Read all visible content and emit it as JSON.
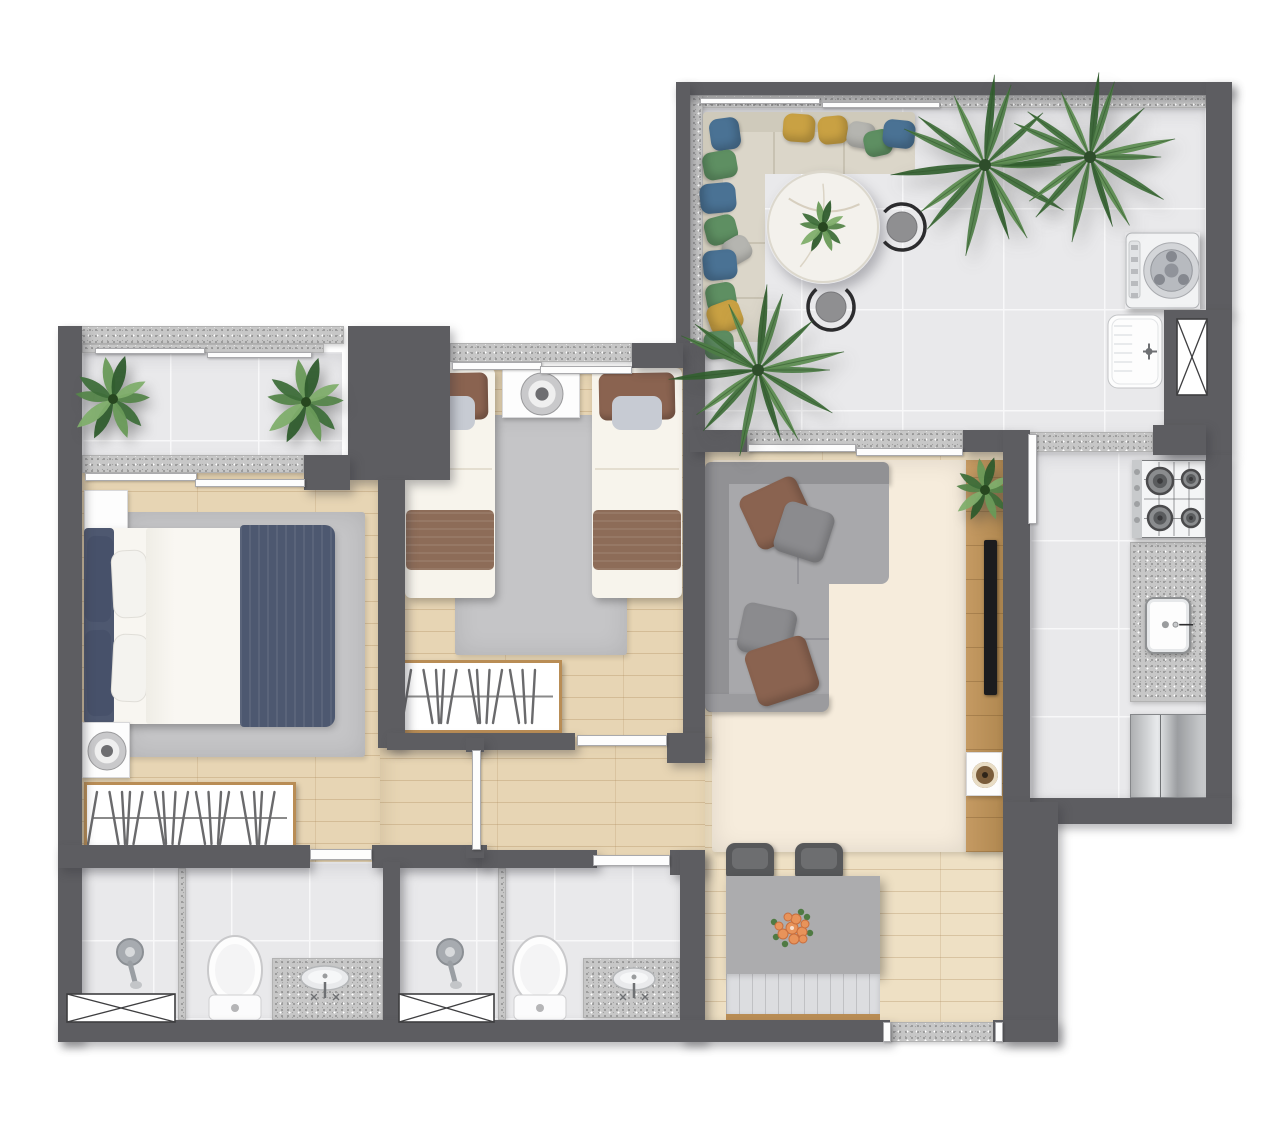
{
  "meta": {
    "description": "top-down rendered apartment floor plan, no visible text",
    "canvas": {
      "w": 1280,
      "h": 1130
    }
  },
  "palette": {
    "wall": "#5d5d61",
    "granite": "#c7c7c7",
    "tile": "#e9e9eb",
    "wood": "#e7d5b4",
    "wood_light": "#eee0c4",
    "rug_gray": "#c5c5c7",
    "rug_cream": "#f6ecdc",
    "sofa_gray": "#a6a6a9",
    "sofa_back": "#919194",
    "terrace_sofa": "#d9d4c6",
    "navy": "#4d5870",
    "brown": "#8a6350",
    "yellow": "#c9a143",
    "blue": "#4a7294",
    "green": "#5e8f62",
    "lt_gray": "#b5b5b0",
    "mid_gray": "#8b8b8e",
    "chair_dark": "#57585a",
    "wood_trim": "#b98d55",
    "marble": "#f3f1ec",
    "steel": "#c0c2c4",
    "plant_green": "#4e7d46",
    "flower_orange": "#e8935a"
  },
  "items": [
    {
      "n": "terrace-floor",
      "k": "tile",
      "r": [
        700,
        107,
        506,
        325
      ],
      "o": {
        "g": 101
      }
    },
    {
      "n": "balcony-floor",
      "k": "tile",
      "r": [
        82,
        352,
        260,
        105
      ],
      "o": {
        "g": 88
      }
    },
    {
      "n": "kitchen-floor",
      "k": "tile",
      "r": [
        1030,
        452,
        176,
        346
      ],
      "o": {
        "g": 88
      }
    },
    {
      "n": "bathroom-1-floor",
      "k": "tile",
      "r": [
        75,
        862,
        310,
        160
      ],
      "o": {
        "g": 78
      }
    },
    {
      "n": "bathroom-2-floor",
      "k": "tile",
      "r": [
        398,
        862,
        284,
        160
      ],
      "o": {
        "g": 78
      }
    },
    {
      "n": "master-bedroom-floor",
      "k": "wood",
      "r": [
        80,
        470,
        300,
        392
      ]
    },
    {
      "n": "twin-bedroom-floor",
      "k": "wood",
      "r": [
        388,
        368,
        295,
        380
      ]
    },
    {
      "n": "hallway-floor",
      "k": "wood",
      "r": [
        380,
        737,
        325,
        125
      ]
    },
    {
      "n": "living-dining-floor",
      "k": "wood",
      "r": [
        705,
        452,
        298,
        570
      ],
      "o": {
        "light": true
      }
    },
    {
      "n": "terrace-top-ledge",
      "k": "granite",
      "r": [
        690,
        95,
        516,
        13
      ]
    },
    {
      "n": "terrace-left-ledge",
      "k": "granite",
      "r": [
        690,
        95,
        13,
        253
      ]
    },
    {
      "n": "balcony-parapet",
      "k": "granite",
      "r": [
        62,
        326,
        282,
        18
      ]
    },
    {
      "n": "balcony-inner-ledge",
      "k": "granite",
      "r": [
        82,
        344,
        242,
        9
      ]
    },
    {
      "n": "balcony-window-sill",
      "k": "granite",
      "r": [
        82,
        455,
        222,
        18
      ]
    },
    {
      "n": "twin-window-sill",
      "k": "granite",
      "r": [
        450,
        343,
        182,
        19
      ]
    },
    {
      "n": "living-window-sill",
      "k": "granite",
      "r": [
        747,
        430,
        216,
        22
      ]
    },
    {
      "n": "kitchen-door-threshold",
      "k": "granite",
      "r": [
        1028,
        432,
        125,
        20
      ]
    },
    {
      "n": "entry-threshold",
      "k": "granite",
      "r": [
        890,
        1022,
        106,
        20
      ]
    },
    {
      "n": "kitchen-counter",
      "k": "granite",
      "r": [
        1130,
        542,
        77,
        160
      ]
    },
    {
      "n": "vanity-1-counter",
      "k": "granite",
      "r": [
        272,
        958,
        111,
        62
      ]
    },
    {
      "n": "vanity-2-counter",
      "k": "granite",
      "r": [
        583,
        958,
        97,
        60
      ]
    },
    {
      "n": "shower-1-divider",
      "k": "granite",
      "r": [
        178,
        868,
        8,
        152
      ]
    },
    {
      "n": "shower-2-divider",
      "k": "granite",
      "r": [
        498,
        868,
        8,
        152
      ]
    },
    {
      "n": "master-rug",
      "k": "rug",
      "r": [
        125,
        512,
        240,
        245
      ],
      "c": "rug_gray"
    },
    {
      "n": "twin-rug",
      "k": "rug",
      "r": [
        455,
        415,
        172,
        240
      ],
      "c": "rug_gray"
    },
    {
      "n": "living-rug",
      "k": "rug",
      "r": [
        712,
        460,
        255,
        392
      ],
      "c": "rug_cream"
    },
    {
      "n": "master-nightstand",
      "k": "nightstand",
      "r": [
        84,
        490,
        44,
        46
      ]
    },
    {
      "n": "master-bed",
      "k": "bed-master",
      "r": [
        84,
        528,
        248,
        196
      ]
    },
    {
      "n": "master-fan",
      "k": "fan",
      "r": [
        82,
        722,
        48,
        56
      ]
    },
    {
      "n": "master-wardrobe",
      "k": "wardrobe",
      "r": [
        84,
        782,
        212,
        72
      ]
    },
    {
      "n": "twin-bed-1",
      "k": "bed-single",
      "r": [
        405,
        368,
        90,
        230
      ]
    },
    {
      "n": "twin-nightstand",
      "k": "nightstand",
      "r": [
        502,
        368,
        78,
        50
      ],
      "o": {
        "dial": true
      }
    },
    {
      "n": "twin-bed-2",
      "k": "bed-single",
      "r": [
        592,
        368,
        90,
        230
      ]
    },
    {
      "n": "twin-wardrobe",
      "k": "wardrobe",
      "r": [
        398,
        660,
        164,
        73
      ]
    },
    {
      "n": "living-sofa",
      "k": "sofa-living",
      "r": [
        705,
        462,
        184,
        250
      ]
    },
    {
      "n": "living-pillow-1",
      "k": "pillow",
      "r": [
        746,
        484,
        62,
        58
      ],
      "c": "brown",
      "rot": -25
    },
    {
      "n": "living-pillow-2",
      "k": "pillow",
      "r": [
        778,
        506,
        52,
        52
      ],
      "c": "mid_gray",
      "rot": 18
    },
    {
      "n": "living-pillow-3",
      "k": "pillow",
      "r": [
        740,
        606,
        54,
        50
      ],
      "c": "mid_gray",
      "rot": 12
    },
    {
      "n": "living-pillow-4",
      "k": "pillow",
      "r": [
        750,
        642,
        64,
        58
      ],
      "c": "brown",
      "rot": -18
    },
    {
      "n": "tv-console",
      "k": "console",
      "r": [
        966,
        460,
        37,
        392
      ]
    },
    {
      "n": "console-plant",
      "k": "plant-leafy",
      "r": [
        951,
        456,
        68,
        68
      ]
    },
    {
      "n": "tv",
      "k": "tv",
      "r": [
        984,
        540,
        13,
        155
      ]
    },
    {
      "n": "console-speaker",
      "k": "speaker",
      "r": [
        966,
        752,
        36,
        44
      ]
    },
    {
      "n": "dining-chair-1",
      "k": "chair-dark",
      "r": [
        726,
        843,
        48,
        35
      ]
    },
    {
      "n": "dining-chair-2",
      "k": "chair-dark",
      "r": [
        795,
        843,
        48,
        35
      ]
    },
    {
      "n": "dining-table",
      "k": "table-gray",
      "r": [
        726,
        876,
        154,
        98
      ]
    },
    {
      "n": "dining-flowers",
      "k": "flowers",
      "r": [
        760,
        896,
        64,
        64
      ]
    },
    {
      "n": "dining-bench",
      "k": "bench",
      "r": [
        726,
        974,
        154,
        47
      ]
    },
    {
      "n": "terrace-sofa",
      "k": "sofa-terrace",
      "r": [
        703,
        112,
        212,
        230
      ]
    },
    {
      "n": "terrace-pillow-1",
      "k": "pillow",
      "r": [
        710,
        118,
        30,
        32
      ],
      "c": "blue",
      "rot": -8
    },
    {
      "n": "terrace-pillow-2",
      "k": "pillow",
      "r": [
        783,
        114,
        32,
        28
      ],
      "c": "yellow",
      "rot": 4
    },
    {
      "n": "terrace-pillow-3",
      "k": "pillow",
      "r": [
        818,
        116,
        30,
        28
      ],
      "c": "yellow",
      "rot": -5
    },
    {
      "n": "terrace-pillow-4",
      "k": "pillow",
      "r": [
        847,
        122,
        28,
        26
      ],
      "c": "lt_gray",
      "rot": 10
    },
    {
      "n": "terrace-pillow-5",
      "k": "pillow",
      "r": [
        864,
        130,
        28,
        26
      ],
      "c": "green",
      "rot": -12
    },
    {
      "n": "terrace-pillow-6",
      "k": "pillow",
      "r": [
        883,
        120,
        32,
        28
      ],
      "c": "blue",
      "rot": 6
    },
    {
      "n": "terrace-pillow-7",
      "k": "pillow",
      "r": [
        706,
        148,
        28,
        34
      ],
      "c": "green",
      "rot": 80
    },
    {
      "n": "terrace-pillow-8",
      "k": "pillow",
      "r": [
        703,
        180,
        30,
        36
      ],
      "c": "blue",
      "rot": 85
    },
    {
      "n": "terrace-pillow-9",
      "k": "pillow",
      "r": [
        707,
        214,
        28,
        32
      ],
      "c": "green",
      "rot": 75
    },
    {
      "n": "terrace-pillow-10",
      "k": "pillow",
      "r": [
        724,
        236,
        26,
        28
      ],
      "c": "lt_gray",
      "rot": 60
    },
    {
      "n": "terrace-pillow-11",
      "k": "pillow",
      "r": [
        705,
        248,
        30,
        34
      ],
      "c": "blue",
      "rot": 85
    },
    {
      "n": "terrace-pillow-12",
      "k": "pillow",
      "r": [
        707,
        282,
        28,
        30
      ],
      "c": "green",
      "rot": 80
    },
    {
      "n": "terrace-pillow-13",
      "k": "pillow",
      "r": [
        710,
        300,
        30,
        34
      ],
      "c": "yellow",
      "rot": 70
    },
    {
      "n": "terrace-pillow-14",
      "k": "pillow",
      "r": [
        705,
        330,
        28,
        30
      ],
      "c": "green",
      "rot": 85
    },
    {
      "n": "terrace-table",
      "k": "round-table",
      "r": [
        766,
        170,
        114,
        114
      ]
    },
    {
      "n": "terrace-chair-1",
      "k": "chair-ring",
      "r": [
        876,
        201,
        52,
        52
      ],
      "o": {
        "a": 221
      }
    },
    {
      "n": "terrace-chair-2",
      "k": "chair-ring",
      "r": [
        805,
        281,
        52,
        52
      ],
      "o": {
        "a": 311
      }
    },
    {
      "n": "washing-machine",
      "k": "washer",
      "r": [
        1125,
        232,
        75,
        77
      ]
    },
    {
      "n": "laundry-tub",
      "k": "tub",
      "r": [
        1107,
        314,
        56,
        75
      ]
    },
    {
      "n": "stove",
      "k": "stove",
      "r": [
        1132,
        460,
        74,
        78
      ]
    },
    {
      "n": "kitchen-sink",
      "k": "sink-square",
      "r": [
        1145,
        597,
        46,
        57
      ]
    },
    {
      "n": "fridge",
      "k": "fridge",
      "r": [
        1130,
        714,
        77,
        84
      ]
    },
    {
      "n": "shower-1",
      "k": "shower",
      "r": [
        113,
        936,
        34,
        56
      ]
    },
    {
      "n": "toilet-1",
      "k": "toilet",
      "r": [
        204,
        934,
        62,
        88
      ]
    },
    {
      "n": "sink-1",
      "k": "sink-oval",
      "r": [
        296,
        962,
        58,
        40
      ]
    },
    {
      "n": "shower-2",
      "k": "shower",
      "r": [
        433,
        936,
        34,
        56
      ]
    },
    {
      "n": "toilet-2",
      "k": "toilet",
      "r": [
        509,
        934,
        62,
        88
      ]
    },
    {
      "n": "sink-2",
      "k": "sink-oval",
      "r": [
        608,
        964,
        52,
        38
      ]
    },
    {
      "n": "terrace-wall-top",
      "k": "wall",
      "r": [
        676,
        82,
        556,
        13
      ]
    },
    {
      "n": "terrace-wall-left",
      "k": "wall",
      "r": [
        676,
        82,
        14,
        268
      ]
    },
    {
      "n": "terrace-wall-right",
      "k": "wall",
      "r": [
        1206,
        82,
        26,
        232
      ]
    },
    {
      "n": "laundry-wall-block",
      "k": "wall",
      "r": [
        1164,
        310,
        68,
        145
      ]
    },
    {
      "n": "kitchen-wall-right",
      "k": "wall",
      "r": [
        1206,
        455,
        26,
        345
      ]
    },
    {
      "n": "kitchen-wall-bottom",
      "k": "wall",
      "r": [
        1030,
        798,
        202,
        26
      ]
    },
    {
      "n": "twin-living-wall",
      "k": "wall",
      "r": [
        683,
        343,
        22,
        407
      ]
    },
    {
      "n": "living-window-wall-left",
      "k": "wall",
      "r": [
        690,
        430,
        57,
        22
      ]
    },
    {
      "n": "living-window-wall-right",
      "k": "wall",
      "r": [
        963,
        430,
        42,
        22
      ]
    },
    {
      "n": "tv-wall",
      "k": "wall",
      "r": [
        1003,
        430,
        27,
        372
      ]
    },
    {
      "n": "dining-wall-right",
      "k": "wall",
      "r": [
        1003,
        802,
        55,
        240
      ]
    },
    {
      "n": "kitchen-door-wall",
      "k": "wall",
      "r": [
        1153,
        425,
        53,
        30
      ]
    },
    {
      "n": "left-wall",
      "k": "wall",
      "r": [
        58,
        326,
        24,
        716
      ]
    },
    {
      "n": "balcony-wall-block",
      "k": "wall",
      "r": [
        348,
        326,
        102,
        154
      ]
    },
    {
      "n": "master-window-wall",
      "k": "wall",
      "r": [
        304,
        455,
        46,
        35
      ]
    },
    {
      "n": "bedrooms-divider-wall",
      "k": "wall",
      "r": [
        378,
        480,
        27,
        268
      ]
    },
    {
      "n": "twin-wall-top-right",
      "k": "wall",
      "r": [
        632,
        343,
        51,
        25
      ]
    },
    {
      "n": "twin-wall-bottom",
      "k": "wall",
      "r": [
        387,
        733,
        188,
        17
      ]
    },
    {
      "n": "twin-wall-bottom-corner",
      "k": "wall",
      "r": [
        667,
        733,
        38,
        30
      ]
    },
    {
      "n": "master-wall-bottom",
      "k": "wall",
      "r": [
        58,
        845,
        252,
        23
      ]
    },
    {
      "n": "hall-wall-1",
      "k": "wall",
      "r": [
        372,
        845,
        115,
        23
      ]
    },
    {
      "n": "hall-wall-2",
      "k": "wall",
      "r": [
        482,
        850,
        115,
        18
      ]
    },
    {
      "n": "bath2-wall-corner",
      "k": "wall",
      "r": [
        670,
        850,
        35,
        25
      ]
    },
    {
      "n": "baths-divider-wall",
      "k": "wall",
      "r": [
        383,
        862,
        17,
        160
      ]
    },
    {
      "n": "bath-dining-wall",
      "k": "wall",
      "r": [
        680,
        850,
        25,
        192
      ]
    },
    {
      "n": "bottom-wall",
      "k": "wall",
      "r": [
        58,
        1020,
        832,
        22
      ]
    },
    {
      "n": "entry-wall-right",
      "k": "wall",
      "r": [
        993,
        1020,
        65,
        22
      ]
    },
    {
      "n": "partition-cap-top",
      "k": "wall",
      "r": [
        466,
        738,
        18,
        14
      ]
    },
    {
      "n": "partition-cap-bottom",
      "k": "wall",
      "r": [
        466,
        846,
        18,
        12
      ]
    },
    {
      "n": "balcony-rail-1",
      "k": "wstrip",
      "r": [
        95,
        348,
        110,
        6
      ]
    },
    {
      "n": "balcony-rail-2",
      "k": "wstrip",
      "r": [
        207,
        352,
        105,
        6
      ]
    },
    {
      "n": "terrace-rail-1",
      "k": "wstrip",
      "r": [
        700,
        98,
        120,
        6
      ]
    },
    {
      "n": "terrace-rail-2",
      "k": "wstrip",
      "r": [
        822,
        102,
        118,
        6
      ]
    },
    {
      "n": "balcony-window-1",
      "k": "wstrip",
      "r": [
        85,
        473,
        112,
        8
      ]
    },
    {
      "n": "balcony-window-2",
      "k": "wstrip",
      "r": [
        195,
        479,
        110,
        8
      ]
    },
    {
      "n": "twin-window-1",
      "k": "wstrip",
      "r": [
        452,
        362,
        90,
        8
      ]
    },
    {
      "n": "twin-window-2",
      "k": "wstrip",
      "r": [
        540,
        366,
        92,
        8
      ]
    },
    {
      "n": "living-window-1",
      "k": "wstrip",
      "r": [
        748,
        444,
        108,
        8
      ]
    },
    {
      "n": "living-window-2",
      "k": "wstrip",
      "r": [
        856,
        448,
        107,
        8
      ]
    },
    {
      "n": "kitchen-door-leaf",
      "k": "wstrip",
      "r": [
        1028,
        434,
        9,
        90
      ]
    },
    {
      "n": "master-bath-door-leaf",
      "k": "wstrip",
      "r": [
        310,
        849,
        62,
        11
      ]
    },
    {
      "n": "twin-door-leaf",
      "k": "wstrip",
      "r": [
        577,
        735,
        90,
        11
      ]
    },
    {
      "n": "bath2-door-leaf",
      "k": "wstrip",
      "r": [
        593,
        855,
        77,
        11
      ]
    },
    {
      "n": "hall-partition",
      "k": "wstrip",
      "r": [
        472,
        750,
        9,
        100
      ]
    },
    {
      "n": "entry-frame-left",
      "k": "wstrip",
      "r": [
        883,
        1022,
        8,
        20
      ]
    },
    {
      "n": "entry-frame-right",
      "k": "wstrip",
      "r": [
        995,
        1022,
        8,
        20
      ]
    },
    {
      "n": "shaft-xbox",
      "k": "xbox",
      "r": [
        1176,
        318,
        32,
        78
      ]
    },
    {
      "n": "bath1-xbox",
      "k": "xbox",
      "r": [
        66,
        993,
        110,
        30
      ]
    },
    {
      "n": "bath2-xbox",
      "k": "xbox",
      "r": [
        398,
        993,
        97,
        30
      ]
    },
    {
      "n": "balcony-plant-left",
      "k": "plant-leafy",
      "r": [
        68,
        353,
        90,
        92
      ]
    },
    {
      "n": "balcony-plant-right",
      "k": "plant-leafy",
      "r": [
        260,
        356,
        92,
        92
      ]
    },
    {
      "n": "terrace-palm-1",
      "k": "palm",
      "r": [
        890,
        70,
        190,
        190
      ]
    },
    {
      "n": "terrace-palm-2",
      "k": "palm",
      "r": [
        1000,
        68,
        180,
        178
      ]
    },
    {
      "n": "terrace-palm-3",
      "k": "palm",
      "r": [
        668,
        280,
        180,
        180
      ]
    }
  ]
}
